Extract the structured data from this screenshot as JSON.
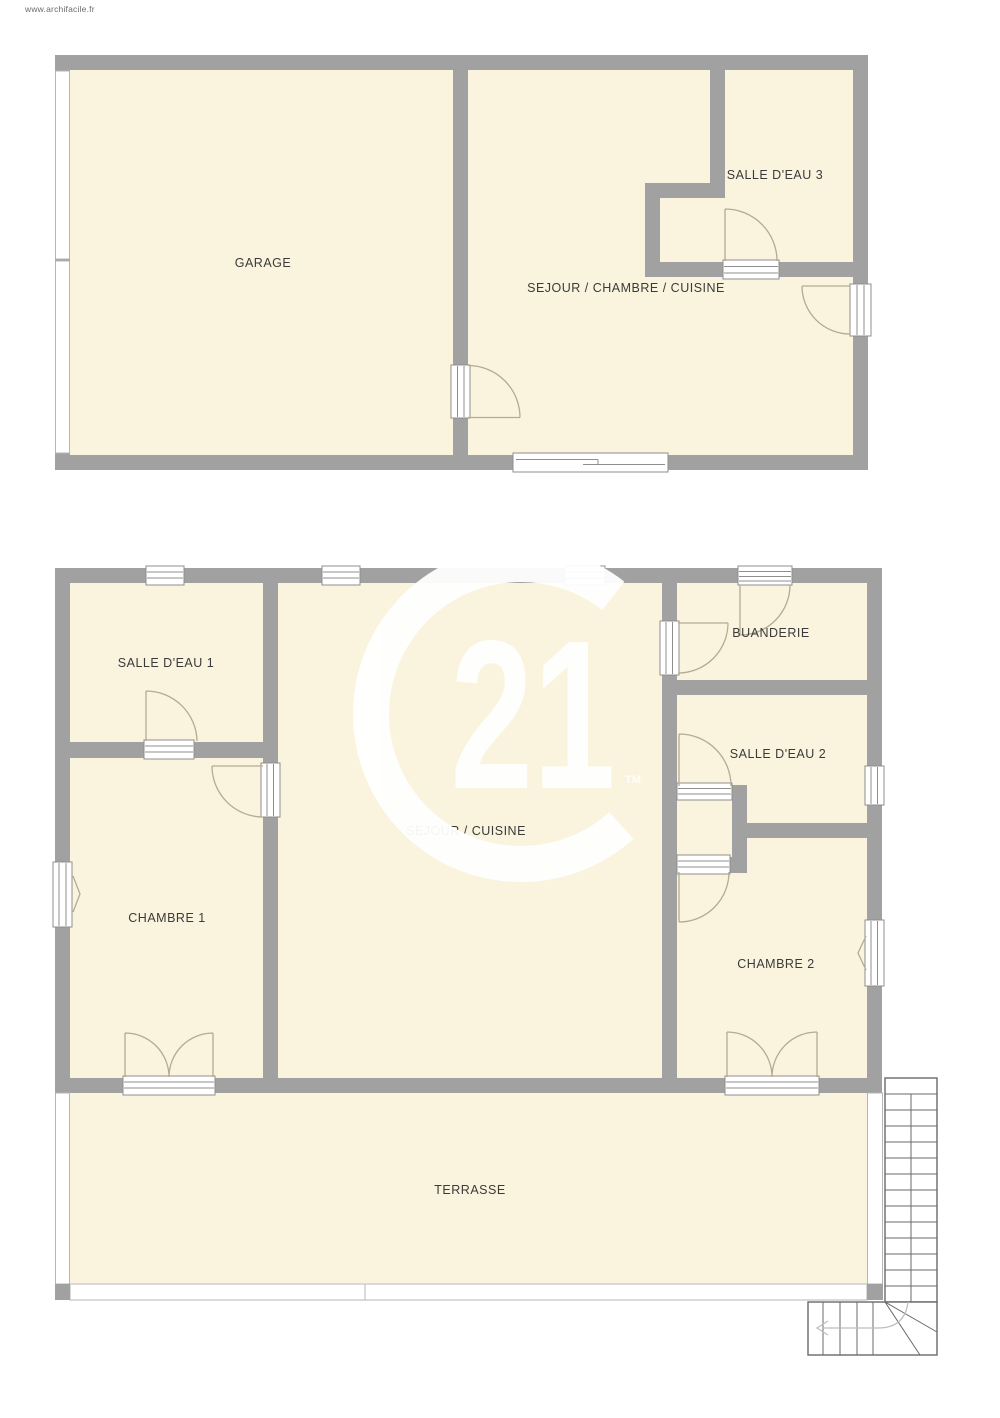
{
  "site_credit": "www.archifacile.fr",
  "floors": [
    {
      "name": "floor-plan-upper",
      "rooms": [
        {
          "label": "GARAGE"
        },
        {
          "label": "SEJOUR / CHAMBRE / CUISINE"
        },
        {
          "label": "SALLE D'EAU 3"
        }
      ]
    },
    {
      "name": "floor-plan-ground",
      "rooms": [
        {
          "label": "SALLE D'EAU 1"
        },
        {
          "label": "CHAMBRE 1"
        },
        {
          "label": "SEJOUR / CUISINE"
        },
        {
          "label": "BUANDERIE"
        },
        {
          "label": "SALLE D'EAU 2"
        },
        {
          "label": "CHAMBRE 2"
        },
        {
          "label": "TERRASSE"
        }
      ]
    }
  ],
  "watermark": {
    "number": "21",
    "trademark": "TM"
  },
  "colors": {
    "page_bg": "#ffffff",
    "wall": "#a1a1a1",
    "room_fill": "#faf4de",
    "door_stroke": "#b5aa92",
    "opening_stroke": "#8f8f8f",
    "stair_stroke": "#6a6a6a",
    "label": "#3a3a3a",
    "watermark": "#ffffff"
  }
}
